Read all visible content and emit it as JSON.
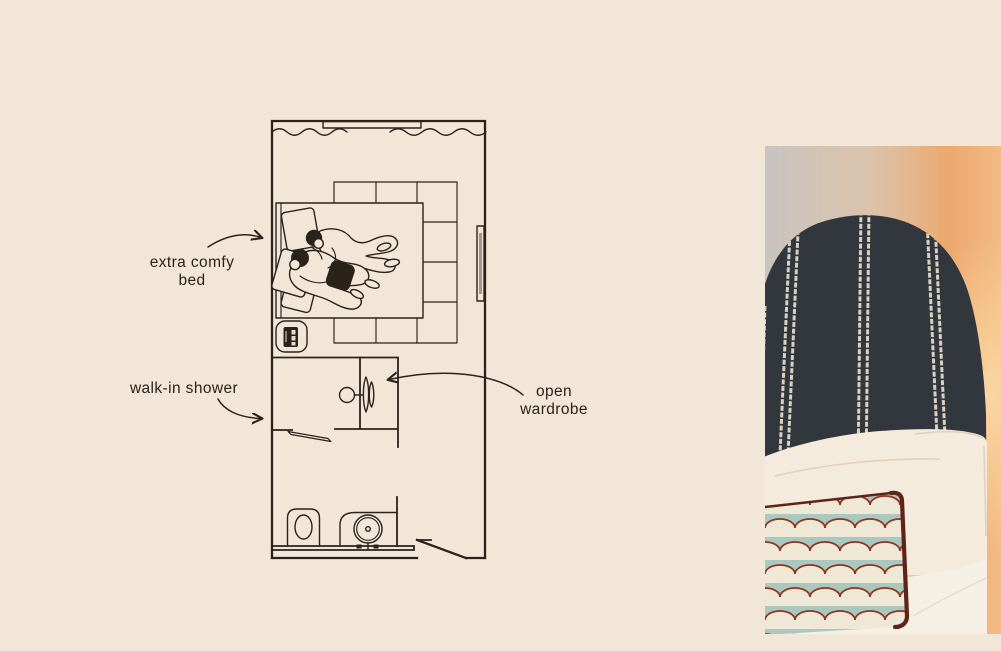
{
  "colors": {
    "background": "#f1e6d8",
    "ink": "#2b2219",
    "photo": {
      "wall_left": "#c9c4c0",
      "wall_mid": "#dbc3ab",
      "wall_glow": "#f3ba83",
      "glow_bright": "#fbd9a4",
      "headboard": "#31373d",
      "stripe": "#d8d1c2",
      "pillow": "#f4ebdd",
      "pillow_shadow": "#ddcbb4",
      "bedding": "#f6efe3",
      "cushion_base": "#efe8d6",
      "cushion_scallop": "#a9c9c0",
      "cushion_outline": "#8e3520",
      "cushion_piping": "#5f2318"
    }
  },
  "floor_plan": {
    "labels": {
      "bed": {
        "line1": "extra comfy",
        "line2": "bed"
      },
      "shower": {
        "line1": "walk-in shower"
      },
      "wardrobe": {
        "line1": "open",
        "line2": "wardrobe"
      }
    },
    "features": [
      "window-curtains",
      "radiator",
      "rug",
      "double-bed",
      "couple-cuddling",
      "pillows",
      "bedside-stool",
      "phone",
      "wall-mirror",
      "open-wardrobe",
      "clothes-hanger",
      "walk-in-shower",
      "shower-door",
      "toilet",
      "sink-basin",
      "vanity-counter",
      "entry-door"
    ]
  },
  "photo": {
    "subject": "bed with arched striped headboard, white pillow and scalloped cushion"
  }
}
